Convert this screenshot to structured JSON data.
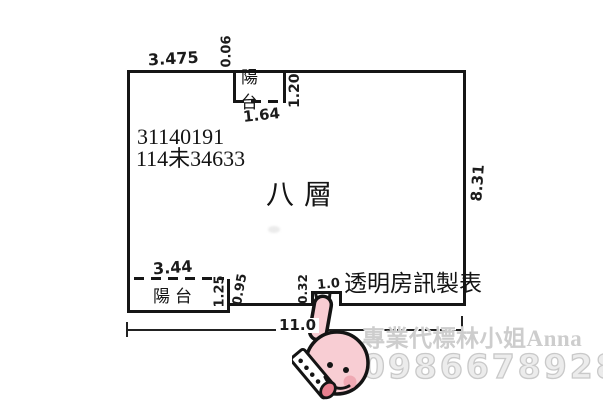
{
  "floorplan": {
    "registration_number": "31140191",
    "registration_code": "114未34633",
    "floor_label": "八層",
    "maker_label": "透明房訊製表",
    "balcony_top_label": "陽台",
    "balcony_bottom_label": "陽台",
    "dimensions": {
      "top_wall_left": "3.475",
      "top_wall_jog": "0.06",
      "balcony_top_width": "1.64",
      "balcony_top_depth": "1.20",
      "right_wall": "8.31",
      "balcony_bottom_width": "3.44",
      "balcony_bottom_depth": "1.25",
      "bottom_step": "0.95",
      "notch_depth": "0.32",
      "notch_width": "1.0",
      "overall_width": "11.0"
    },
    "line_color": "#161616"
  },
  "watermark": {
    "agent_text": "專業代標林小姐Anna",
    "phone": "0986678928",
    "text_color": "#cdcdcd"
  },
  "illustration": {
    "name": "thumbs-up-hand-sticker",
    "skin_color": "#f8cdd3",
    "cheek_color": "#efa9b3",
    "tongue_color": "#e8808f",
    "cuff_color": "#ffffff",
    "outline_color": "#141414"
  }
}
